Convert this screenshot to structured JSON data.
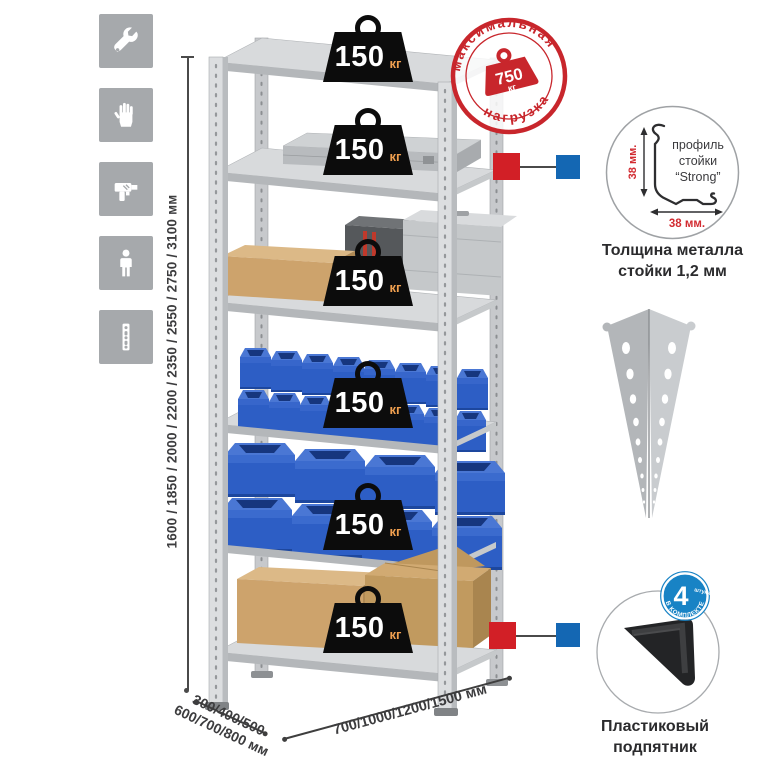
{
  "assembly_icons": {
    "tile_color": "#a6a9ac",
    "items": [
      {
        "icon": "wrench-icon"
      },
      {
        "icon": "gloves-icon"
      },
      {
        "icon": "drill-icon"
      },
      {
        "icon": "person-icon"
      },
      {
        "icon": "perforated-post-icon"
      }
    ]
  },
  "dimensions": {
    "height_label": "1600 / 1850 / 2000 / 2200 / 2350 / 2550 / 2750 / 3100 мм",
    "depth_line1": "300/400/500",
    "depth_line2": "600/700/800 мм",
    "width_label": "700/1000/1200/1500 мм"
  },
  "weights": [
    {
      "value": "150",
      "unit": "кг"
    },
    {
      "value": "150",
      "unit": "кг"
    },
    {
      "value": "150",
      "unit": "кг"
    },
    {
      "value": "150",
      "unit": "кг"
    },
    {
      "value": "150",
      "unit": "кг"
    },
    {
      "value": "150",
      "unit": "кг"
    }
  ],
  "max_load_stamp": {
    "arc_top": "максимальная",
    "arc_bottom": "нагрузка",
    "value": "750",
    "unit": "кг"
  },
  "profile_detail": {
    "label_line1": "профиль",
    "label_line2": "стойки",
    "label_line3": "“Strong”",
    "vertical_dim": "38 мм.",
    "horizontal_dim": "38 мм.",
    "caption_line1": "Толщина металла",
    "caption_line2": "стойки 1,2 мм"
  },
  "foot_detail": {
    "badge_count": "4",
    "badge_count_word": "штуки",
    "badge_arc": "В КОМПЛЕКТЕ",
    "caption_line1": "Пластиковый",
    "caption_line2": "подпятник"
  },
  "colors": {
    "stamp_red": "#c8262c",
    "marker_red": "#d21f26",
    "marker_blue": "#1467b3",
    "bin_blue": "#2d5ec5",
    "badge_blue": "#1883c5",
    "tile_gray": "#a6a9ac"
  }
}
